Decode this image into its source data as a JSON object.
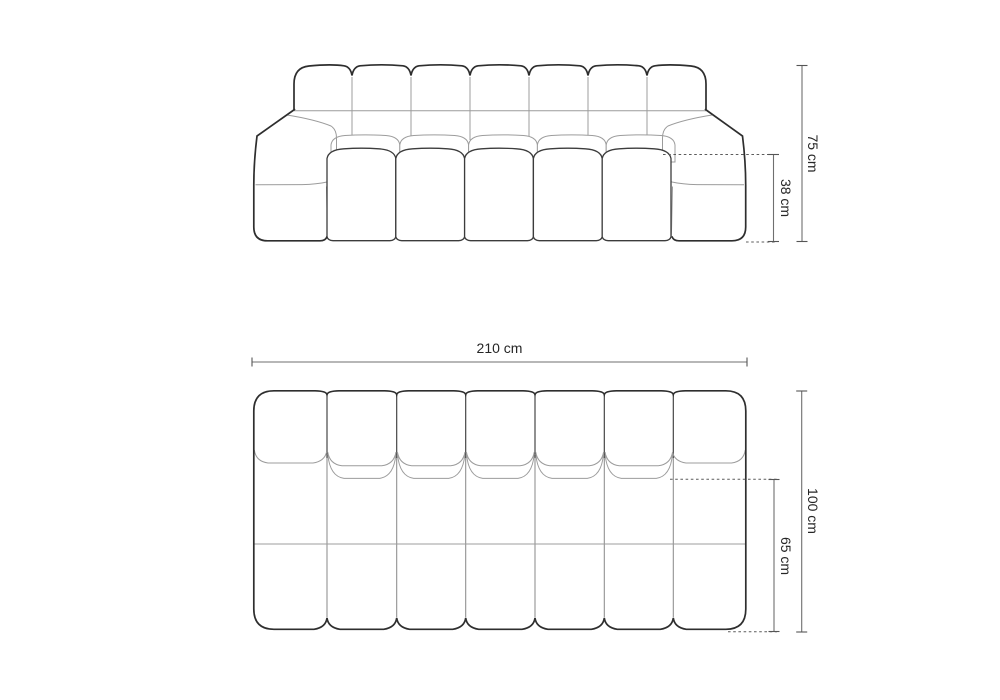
{
  "diagram": {
    "background": "#ffffff",
    "front_view": {
      "name": "sofa front elevation",
      "back_cushion_count": 7,
      "seat_cushion_count": 5,
      "dimensions": {
        "total_height": "75 cm",
        "seat_height": "38 cm"
      }
    },
    "top_view": {
      "name": "sofa top plan",
      "column_count": 7,
      "dimensions": {
        "total_width": "210 cm",
        "total_depth": "100 cm",
        "seat_depth": "65 cm"
      }
    },
    "style": {
      "outline_color": "#2e2e2e",
      "secondary_line_color": "#9c9c9c",
      "dimension_line_color": "#6f6f6f",
      "text_color": "#262626"
    }
  }
}
